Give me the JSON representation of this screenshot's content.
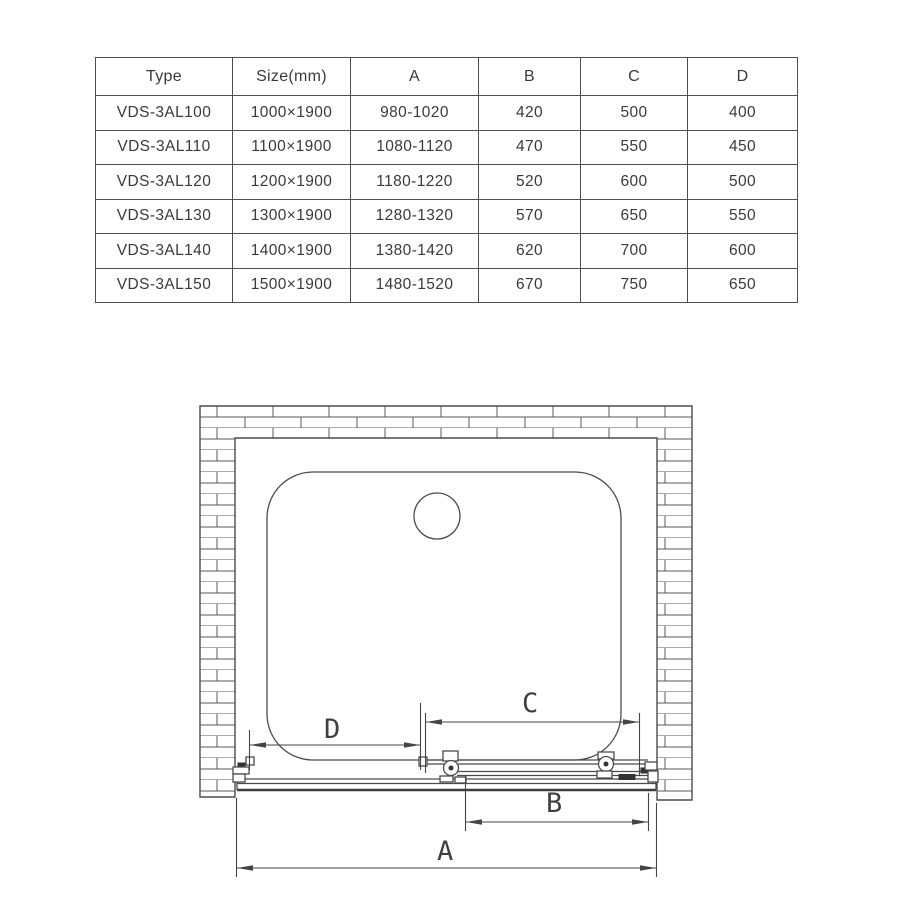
{
  "table": {
    "headers": [
      "Type",
      "Size(mm)",
      "A",
      "B",
      "C",
      "D"
    ],
    "rows": [
      [
        "VDS-3AL100",
        "1000×1900",
        "980-1020",
        "420",
        "500",
        "400"
      ],
      [
        "VDS-3AL110",
        "1100×1900",
        "1080-1120",
        "470",
        "550",
        "450"
      ],
      [
        "VDS-3AL120",
        "1200×1900",
        "1180-1220",
        "520",
        "600",
        "500"
      ],
      [
        "VDS-3AL130",
        "1300×1900",
        "1280-1320",
        "570",
        "650",
        "550"
      ],
      [
        "VDS-3AL140",
        "1400×1900",
        "1380-1420",
        "620",
        "700",
        "600"
      ],
      [
        "VDS-3AL150",
        "1500×1900",
        "1480-1520",
        "670",
        "750",
        "650"
      ]
    ]
  },
  "diagram": {
    "labels": {
      "a": "A",
      "b": "B",
      "c": "C",
      "d": "D"
    },
    "colors": {
      "line": "#4b4b4b",
      "dimension": "#454545",
      "text": "#3f3f3f"
    }
  }
}
